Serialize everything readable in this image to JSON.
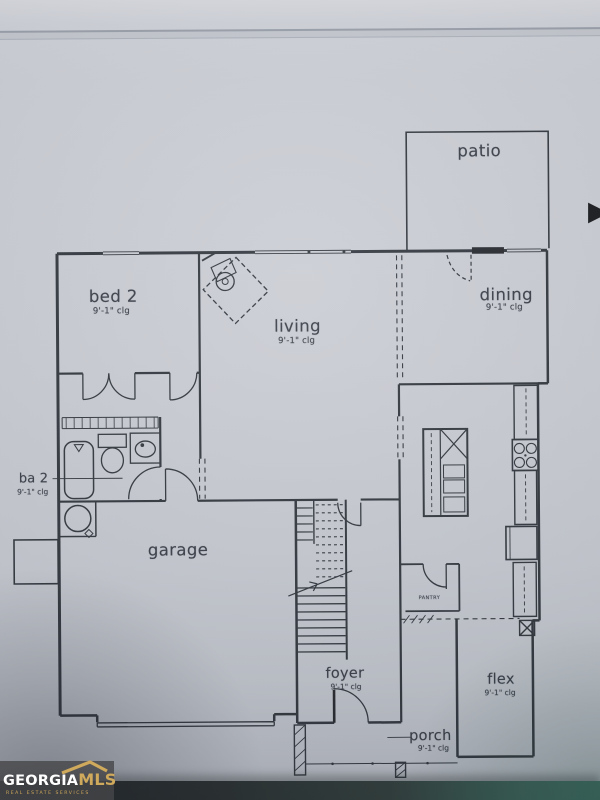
{
  "colors": {
    "paper": "#c8cbd2",
    "ink": "#2f343c",
    "watermark_gold": "#cfa95c",
    "watermark_bg": "#474749",
    "bottom_band_teal": "#3f6a60"
  },
  "rooms": {
    "patio": {
      "label": "patio"
    },
    "bed2": {
      "label": "bed 2",
      "clg": "9'-1\" clg"
    },
    "living": {
      "label": "living",
      "clg": "9'-1\" clg"
    },
    "dining": {
      "label": "dining",
      "clg": "9'-1\" clg"
    },
    "ba2": {
      "label": "ba 2",
      "clg": "9'-1\" clg"
    },
    "garage": {
      "label": "garage"
    },
    "pantry": {
      "label": "PANTRY"
    },
    "foyer": {
      "label": "foyer",
      "clg": "9'-1\" clg"
    },
    "flex": {
      "label": "flex",
      "clg": "9'-1\" clg"
    },
    "porch": {
      "label": "porch",
      "clg": "9'-1\" clg"
    }
  },
  "watermark": {
    "brand": "GEORGIA",
    "brand_suffix": "MLS",
    "tagline": "REAL ESTATE SERVICES"
  },
  "icons": {
    "next_arrow": "▶"
  }
}
